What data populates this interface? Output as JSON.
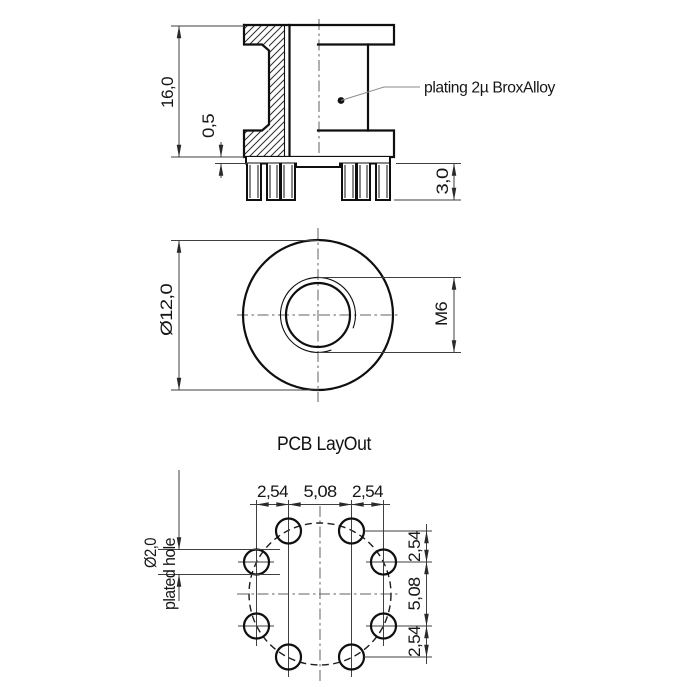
{
  "side_view": {
    "dim_height": "16,0",
    "dim_standoff": "0,5",
    "dim_pin_length": "3,0",
    "note_plating": "plating 2µ BroxAlloy"
  },
  "top_view": {
    "dim_outer_diameter": "Ø12,0",
    "dim_thread": "M6"
  },
  "pcb_view": {
    "title": "PCB LayOut",
    "hole_label_line1": "Ø2,0",
    "hole_label_line2": "plated hole",
    "dims_horizontal": [
      "2,54",
      "5,08",
      "2,54"
    ],
    "dims_vertical": [
      "2,54",
      "5,08",
      "2,54"
    ]
  },
  "colors": {
    "background": "#ffffff",
    "outline": "#0f0f0f",
    "dimension_lines": "#3f3f3f",
    "text": "#161616"
  }
}
